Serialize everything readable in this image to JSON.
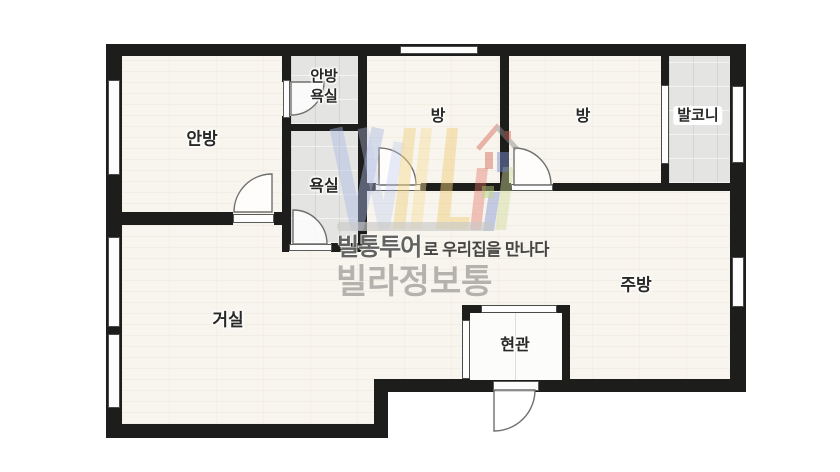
{
  "floorplan": {
    "labels": {
      "master_bedroom": "안방",
      "master_bath_line1": "안방",
      "master_bath_line2": "욕실",
      "bathroom": "욕실",
      "room_1": "방",
      "room_2": "방",
      "balcony": "발코니",
      "living_room": "거실",
      "kitchen": "주방",
      "entrance": "현관"
    },
    "colors": {
      "wall": "#1d1d1b",
      "floor": "#f8f5ee",
      "tile": "#e4e4e2",
      "entry_floor": "#fcfcfb",
      "background": "#ffffff"
    }
  },
  "watermark": {
    "tagline_bold": "빌통투어",
    "tagline_rest": "로 우리집을 만나다",
    "brand": "빌라정보통",
    "colors": {
      "brand_text": "#b5b2ae",
      "tagline_text": "#454543",
      "logo_blue": "#aab8e2",
      "logo_yellow": "#f2d486",
      "logo_green": "#ccd897",
      "logo_red": "#e2705f",
      "logo_navy": "#7d90d2"
    }
  }
}
